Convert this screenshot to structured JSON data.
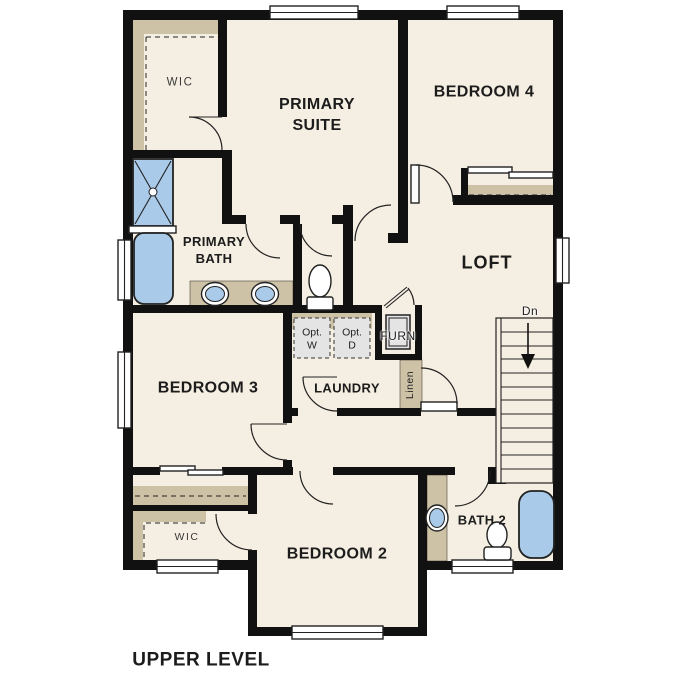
{
  "plan_title": "UPPER LEVEL",
  "colors": {
    "floor": "#f5eee2",
    "wall": "#111111",
    "tan": "#cdc1a6",
    "fixture_blue": "#a9cae8",
    "appliance_gray": "#e4e4e4",
    "label": "#1c1c1c"
  },
  "labels": {
    "primary_wic": "WIC",
    "primary_suite": "PRIMARY\nSUITE",
    "bedroom4": "BEDROOM 4",
    "primary_bath": "PRIMARY\nBATH",
    "loft": "LOFT",
    "opt_washer": "Opt.\nW",
    "opt_dryer": "Opt.\nD",
    "furnace": "FURN",
    "laundry": "LAUNDRY",
    "linen": "Linen",
    "bedroom3": "BEDROOM 3",
    "stairs_down": "Dn",
    "bedroom2": "BEDROOM 2",
    "bath2": "BATH 2",
    "bedroom2_wic": "WIC",
    "title": "UPPER LEVEL"
  }
}
